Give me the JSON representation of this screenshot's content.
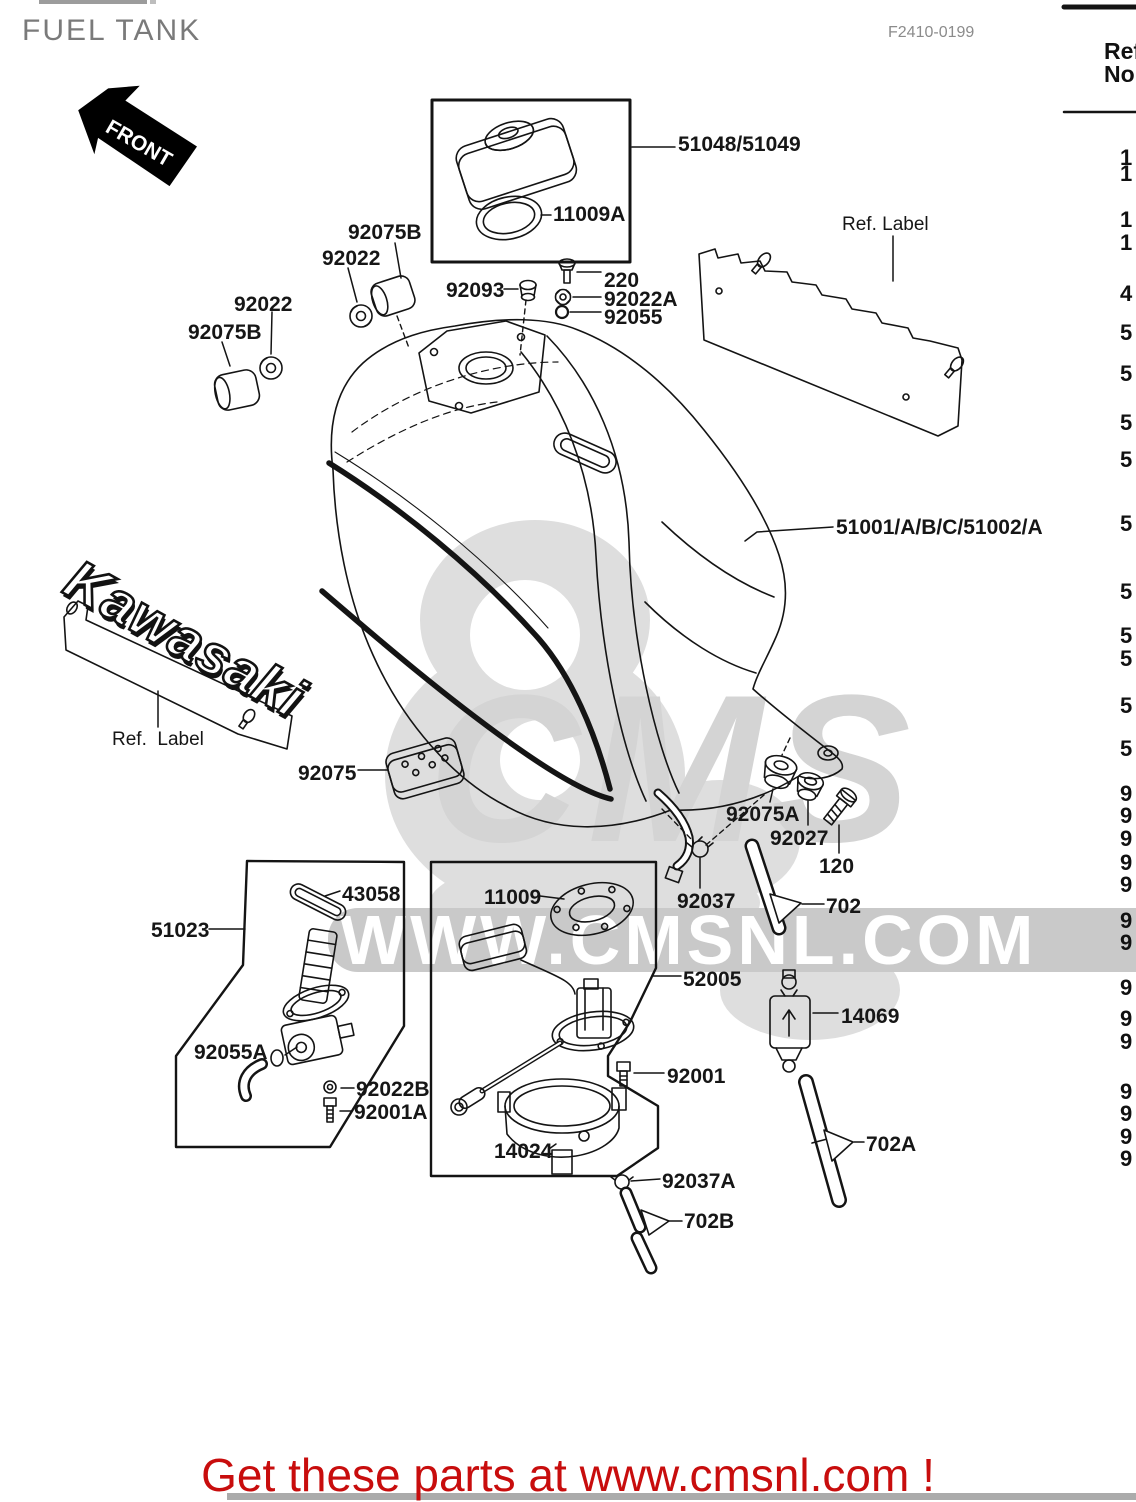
{
  "header": {
    "title": "FUEL TANK",
    "fiche_code": "F2410-0199"
  },
  "ref_table": {
    "col_header_line1": "Ref.",
    "col_header_line2": "No.",
    "digits": [
      {
        "v": "1",
        "y": 145
      },
      {
        "v": "1",
        "y": 161
      },
      {
        "v": "1",
        "y": 207
      },
      {
        "v": "1",
        "y": 230
      },
      {
        "v": "4",
        "y": 281
      },
      {
        "v": "5",
        "y": 320
      },
      {
        "v": "5",
        "y": 361
      },
      {
        "v": "5",
        "y": 410
      },
      {
        "v": "5",
        "y": 447
      },
      {
        "v": "5",
        "y": 511
      },
      {
        "v": "5",
        "y": 579
      },
      {
        "v": "5",
        "y": 623
      },
      {
        "v": "5",
        "y": 646
      },
      {
        "v": "5",
        "y": 693
      },
      {
        "v": "5",
        "y": 736
      },
      {
        "v": "9",
        "y": 781
      },
      {
        "v": "9",
        "y": 803
      },
      {
        "v": "9",
        "y": 826
      },
      {
        "v": "9",
        "y": 850
      },
      {
        "v": "9",
        "y": 872
      },
      {
        "v": "9",
        "y": 908
      },
      {
        "v": "9",
        "y": 930
      },
      {
        "v": "9",
        "y": 975
      },
      {
        "v": "9",
        "y": 1006
      },
      {
        "v": "9",
        "y": 1029
      },
      {
        "v": "9",
        "y": 1079
      },
      {
        "v": "9",
        "y": 1101
      },
      {
        "v": "9",
        "y": 1124
      },
      {
        "v": "9",
        "y": 1146
      }
    ]
  },
  "diagram": {
    "front_badge_text": "FRONT",
    "emblem_text": "Kawasaki",
    "labels": [
      {
        "text": "51048/51049",
        "x": 678,
        "y": 133
      },
      {
        "text": "11009A",
        "x": 553,
        "y": 203
      },
      {
        "text": "92075B",
        "x": 348,
        "y": 221
      },
      {
        "text": "92022",
        "x": 322,
        "y": 247
      },
      {
        "text": "92022",
        "x": 234,
        "y": 293
      },
      {
        "text": "92075B",
        "x": 188,
        "y": 321
      },
      {
        "text": "92093",
        "x": 446,
        "y": 279
      },
      {
        "text": "220",
        "x": 604,
        "y": 269
      },
      {
        "text": "92022A",
        "x": 604,
        "y": 288
      },
      {
        "text": "92055",
        "x": 604,
        "y": 306
      },
      {
        "text": "Ref. Label",
        "x": 842,
        "y": 214,
        "fs": 19,
        "fw": 400
      },
      {
        "text": "51001/A/B/C/51002/A",
        "x": 836,
        "y": 516
      },
      {
        "text": "Ref.  Label",
        "x": 112,
        "y": 729,
        "fs": 19,
        "fw": 400
      },
      {
        "text": "92075",
        "x": 298,
        "y": 762
      },
      {
        "text": "92075A",
        "x": 726,
        "y": 803
      },
      {
        "text": "92027",
        "x": 770,
        "y": 827
      },
      {
        "text": "120",
        "x": 819,
        "y": 855
      },
      {
        "text": "92037",
        "x": 677,
        "y": 890
      },
      {
        "text": "702",
        "x": 826,
        "y": 895
      },
      {
        "text": "51023",
        "x": 151,
        "y": 919
      },
      {
        "text": "43058",
        "x": 342,
        "y": 883
      },
      {
        "text": "92055A",
        "x": 194,
        "y": 1041
      },
      {
        "text": "92022B",
        "x": 356,
        "y": 1078
      },
      {
        "text": "92001A",
        "x": 354,
        "y": 1101
      },
      {
        "text": "11009",
        "x": 484,
        "y": 886
      },
      {
        "text": "52005",
        "x": 683,
        "y": 968
      },
      {
        "text": "92001",
        "x": 667,
        "y": 1065
      },
      {
        "text": "14024",
        "x": 494,
        "y": 1140
      },
      {
        "text": "92037A",
        "x": 662,
        "y": 1170
      },
      {
        "text": "702B",
        "x": 684,
        "y": 1210
      },
      {
        "text": "14069",
        "x": 841,
        "y": 1005
      },
      {
        "text": "702A",
        "x": 866,
        "y": 1133
      }
    ]
  },
  "watermark": {
    "big_text": "CMS",
    "band_text": "WWW.CMSNL.COM"
  },
  "footer": {
    "banner_text": "Get these parts at www.cmsnl.com !",
    "banner_color": "#c80d0d"
  }
}
